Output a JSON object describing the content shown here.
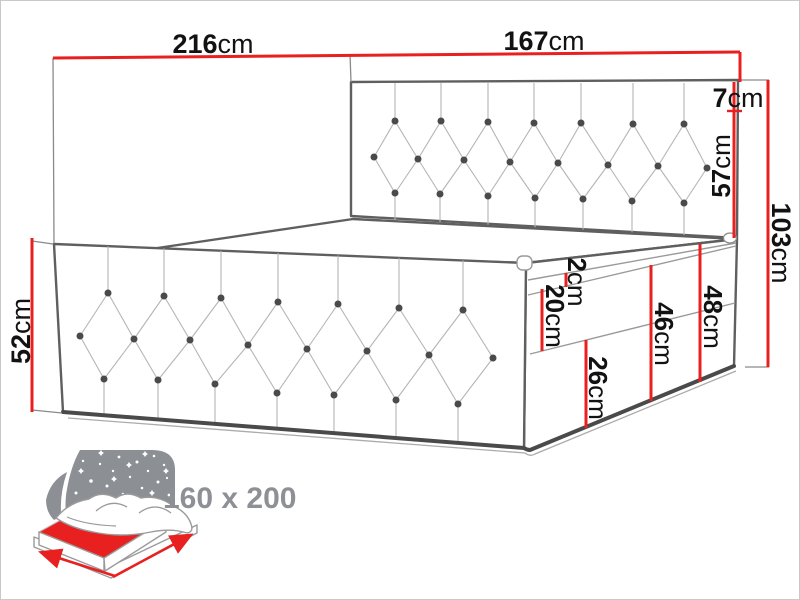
{
  "title": "Upholstered continental bed dimension diagram",
  "dims": {
    "w216": {
      "value": "216",
      "unit": "cm"
    },
    "w167": {
      "value": "167",
      "unit": "cm"
    },
    "h7": {
      "value": "7",
      "unit": "cm"
    },
    "h57": {
      "value": "57",
      "unit": "cm"
    },
    "h103": {
      "value": "103",
      "unit": "cm"
    },
    "h52": {
      "value": "52",
      "unit": "cm"
    },
    "t2": {
      "value": "2",
      "unit": "cm"
    },
    "t20": {
      "value": "20",
      "unit": "cm"
    },
    "t26": {
      "value": "26",
      "unit": "cm"
    },
    "t46": {
      "value": "46",
      "unit": "cm"
    },
    "t48": {
      "value": "48",
      "unit": "cm"
    }
  },
  "icon": {
    "size_label": "160 x 200"
  },
  "colors": {
    "dimension_red": "#e8201f",
    "outline_gray": "#5f5f5f",
    "icon_gray": "#8c9094",
    "label_text": "#121212",
    "size_text": "#8d9094"
  }
}
